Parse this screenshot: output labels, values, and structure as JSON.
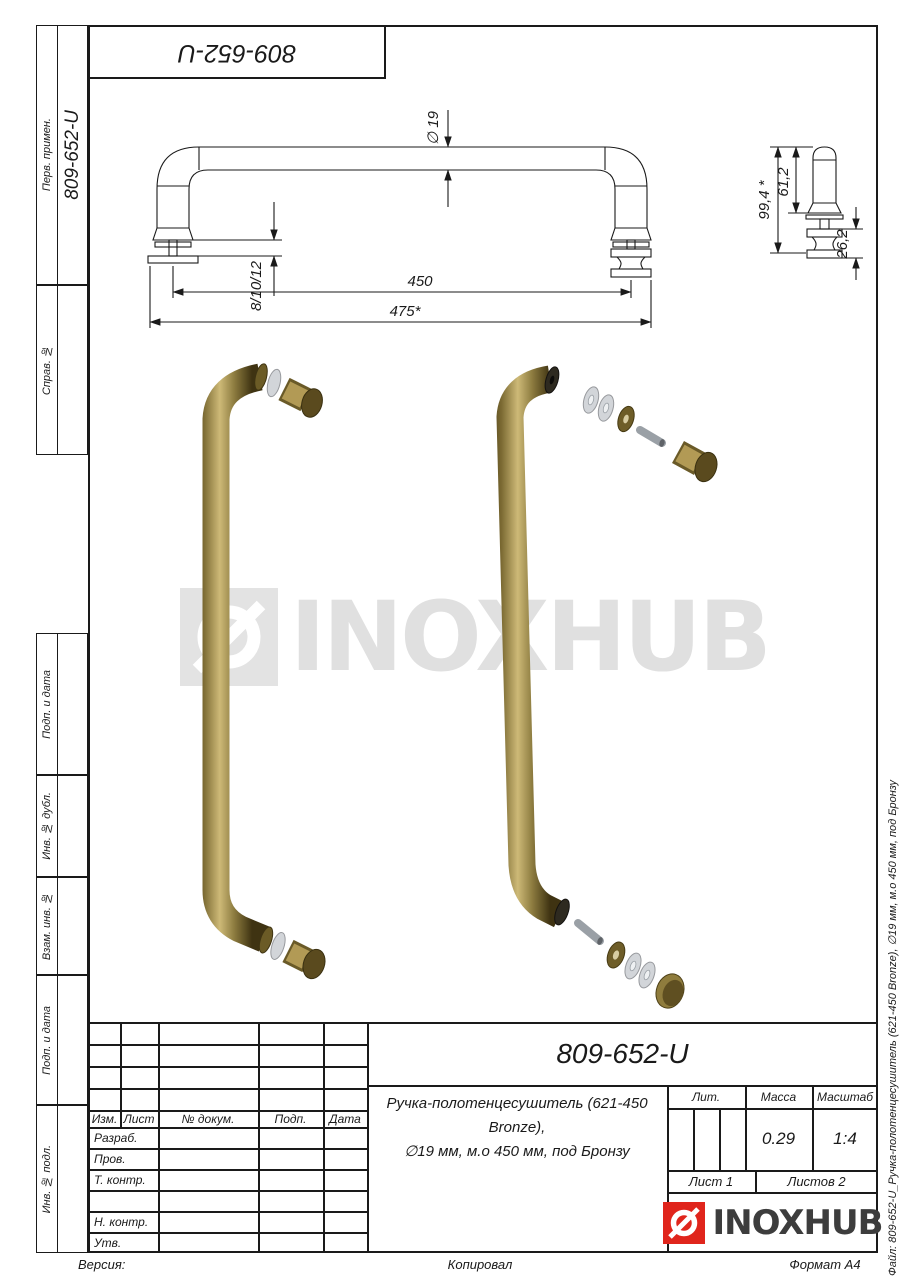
{
  "sheet": {
    "corner_stamp": "809-652-U",
    "footer": {
      "version": "Версия:",
      "copied": "Копировал",
      "format": "Формат А4"
    },
    "file_label": "Файл: 809-652-U_Ручка-полотенцесушитель (621-450 Bronze), ∅19 мм, м.о 450 мм, под Бронзу"
  },
  "left_strip": {
    "perv_primen": "Перв. примен.",
    "perv_primen_value": "809-652-U",
    "sprav_no": "Справ. №",
    "podp_data_1": "Подп. и дата",
    "inv_dubl": "Инв. № дубл.",
    "vzam_inv": "Взам. инв. №",
    "podp_data_2": "Подп. и дата",
    "inv_podl": "Инв. № подл."
  },
  "drawing": {
    "front_dims": {
      "diameter": "∅ 19",
      "glass_thickness": "8/10/12",
      "mounting_distance": "450",
      "overall_length": "475*"
    },
    "side_dims": {
      "overall_height": "99,4 *",
      "upper_height": "61,2",
      "knob_height": "26,2"
    }
  },
  "watermark": {
    "text": "INOXHUB"
  },
  "title_block": {
    "designation": "809-652-U",
    "name_line1": "Ручка-полотенцесушитель (621-450 Bronze),",
    "name_line2": "∅19 мм, м.о 450 мм, под Бронзу",
    "header": {
      "izm": "Изм.",
      "list": "Лист",
      "dokum": "№ докум.",
      "podp": "Подп.",
      "data": "Дата"
    },
    "rows": {
      "razrab": "Разраб.",
      "prov": "Пров.",
      "t_kontr": "Т. контр.",
      "n_kontr": "Н. контр.",
      "utv": "Утв."
    },
    "lit": "Лит.",
    "massa": "Масса",
    "masshtab": "Масштаб",
    "massa_value": "0.29",
    "masshtab_value": "1:4",
    "list_value": "Лист 1",
    "listov_value": "Листов 2",
    "logo_text": "INOXHUB"
  },
  "colors": {
    "logo_red": "#e0251c",
    "bronze": "#8b7a3e",
    "watermark_gray": "#e0e0e0",
    "line_black": "#1a1a1a"
  }
}
